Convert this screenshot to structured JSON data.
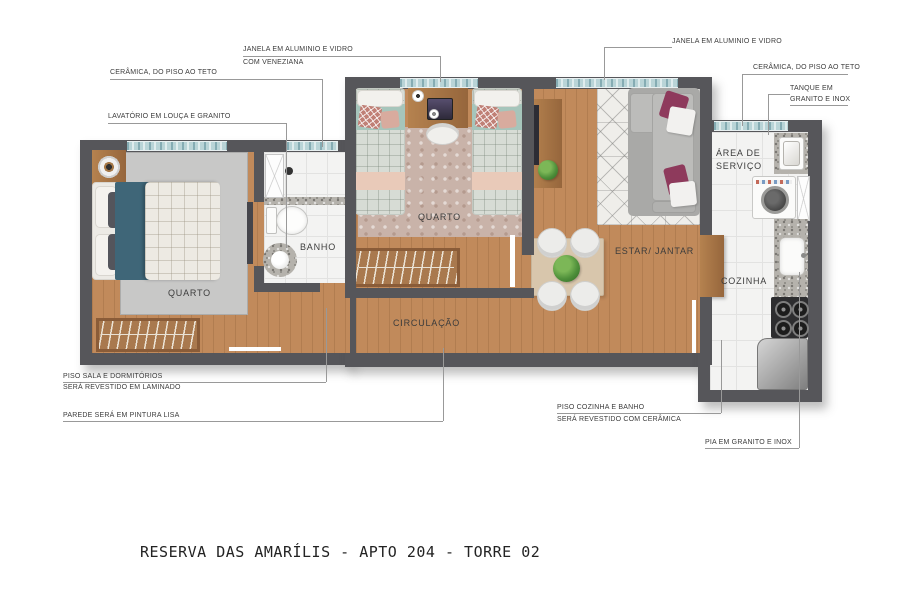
{
  "title": "RESERVA DAS AMARÍLIS - APTO 204 - TORRE 02",
  "rooms": {
    "bedroom1": "QUARTO",
    "bedroom2": "QUARTO",
    "bathroom": "BANHO",
    "hallway": "CIRCULAÇÃO",
    "living": "ESTAR/ JANTAR",
    "kitchen": "COZINHA",
    "service_l1": "ÁREA DE",
    "service_l2": "SERVIÇO"
  },
  "annotations": {
    "window_left_l1": "JANELA EM ALUMINIO E VIDRO",
    "window_left_l2": "COM VENEZIANA",
    "ceramic_left": "CERÂMICA, DO PISO AO TETO",
    "lavatory": "LAVATÓRIO EM LOUÇA E GRANITO",
    "window_right": "JANELA EM ALUMINIO E VIDRO",
    "ceramic_right": "CERÂMICA, DO PISO AO TETO",
    "tank_l1": "TANQUE EM",
    "tank_l2": "GRANITO E INOX",
    "laminate_l1": "PISO SALA E DORMITÓRIOS",
    "laminate_l2": "SERÁ REVESTIDO EM LAMINADO",
    "paint": "PAREDE SERÁ EM PINTURA LISA",
    "ceramic_floor_l1": "PISO COZINHA E BANHO",
    "ceramic_floor_l2": "SERÁ REVESTIDO COM CERÂMICA",
    "sink": "PIA EM GRANITO E INOX"
  },
  "colors": {
    "wall": "#56565a",
    "wood": "#c18a5b",
    "windowBlue": "#b9d4d7",
    "rugGray": "#c8c8c7",
    "rugPink": "#c9b3a9",
    "teal": "#3f6678",
    "magenta": "#8e3a5c",
    "furnitureBrown": "#a8784e",
    "plantGreen": "#4e8f3a",
    "labelColor": "#3c3c3c",
    "lineColor": "#999999",
    "titleColor": "#232323"
  }
}
